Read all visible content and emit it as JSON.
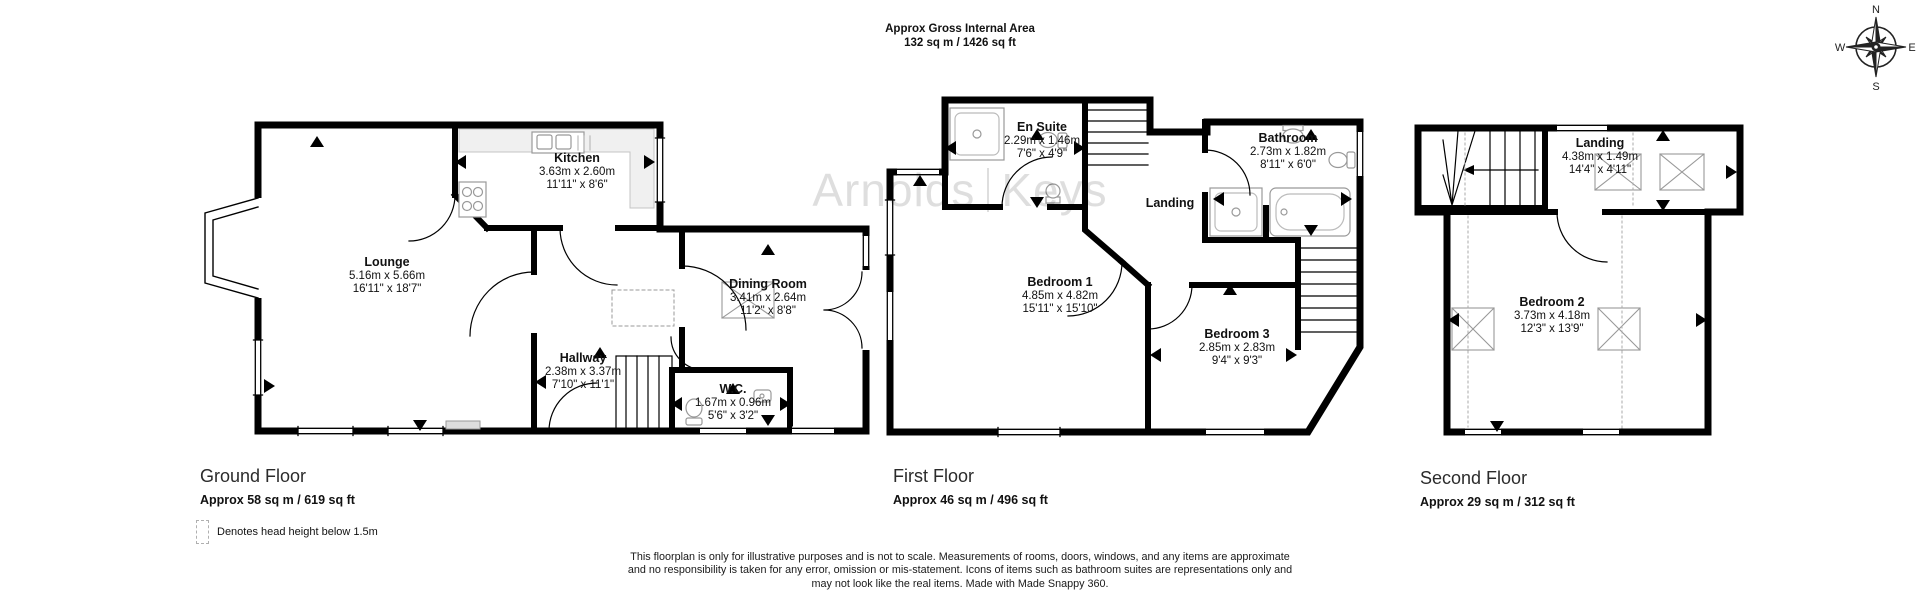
{
  "header": {
    "line1": "Approx Gross Internal Area",
    "line2": "132 sq m / 1426 sq ft"
  },
  "watermark": {
    "brand_left": "Arnolds",
    "brand_right": "Keys"
  },
  "compass": {
    "n": "N",
    "e": "E",
    "s": "S",
    "w": "W"
  },
  "floors": [
    {
      "name": "Ground Floor",
      "area": "Approx 58 sq m / 619 sq ft",
      "rooms": [
        {
          "name": "Lounge",
          "metric": "5.16m x 5.66m",
          "imperial": "16'11\" x 18'7\""
        },
        {
          "name": "Kitchen",
          "metric": "3.63m x 2.60m",
          "imperial": "11'11\" x 8'6\""
        },
        {
          "name": "Dining Room",
          "metric": "3.41m x 2.64m",
          "imperial": "11'2\" x 8'8\""
        },
        {
          "name": "Hallway",
          "metric": "2.38m x 3.37m",
          "imperial": "7'10\" x 11'1\""
        },
        {
          "name": "W.C.",
          "metric": "1.67m x 0.96m",
          "imperial": "5'6\" x 3'2\""
        }
      ]
    },
    {
      "name": "First Floor",
      "area": "Approx 46 sq m / 496 sq ft",
      "rooms": [
        {
          "name": "En Suite",
          "metric": "2.29m x 1.46m",
          "imperial": "7'6\" x 4'9\""
        },
        {
          "name": "Bathroom",
          "metric": "2.73m x 1.82m",
          "imperial": "8'11\" x 6'0\""
        },
        {
          "name": "Landing",
          "metric": "",
          "imperial": ""
        },
        {
          "name": "Bedroom 1",
          "metric": "4.85m x 4.82m",
          "imperial": "15'11\" x 15'10\""
        },
        {
          "name": "Bedroom 3",
          "metric": "2.85m x 2.83m",
          "imperial": "9'4\" x 9'3\""
        }
      ]
    },
    {
      "name": "Second Floor",
      "area": "Approx 29 sq m / 312 sq ft",
      "rooms": [
        {
          "name": "Landing",
          "metric": "4.38m x 1.49m",
          "imperial": "14'4\" x 4'11\""
        },
        {
          "name": "Bedroom 2",
          "metric": "3.73m x 4.18m",
          "imperial": "12'3\" x 13'9\""
        }
      ]
    }
  ],
  "legend": {
    "label": "Denotes head height below 1.5m"
  },
  "disclaimer": {
    "line1": "This floorplan is only for illustrative purposes and is not to scale. Measurements of rooms, doors, windows, and any items are approximate",
    "line2": "and no responsibility is taken for any error, omission or mis-statement. Icons of items such as bathroom suites are representations only and",
    "line3": "may not look like the real items. Made with Made Snappy 360."
  },
  "colors": {
    "wall": "#000000",
    "fixture": "#999999",
    "watermark": "#e2e2e2",
    "dashed": "#aaaaaa"
  }
}
